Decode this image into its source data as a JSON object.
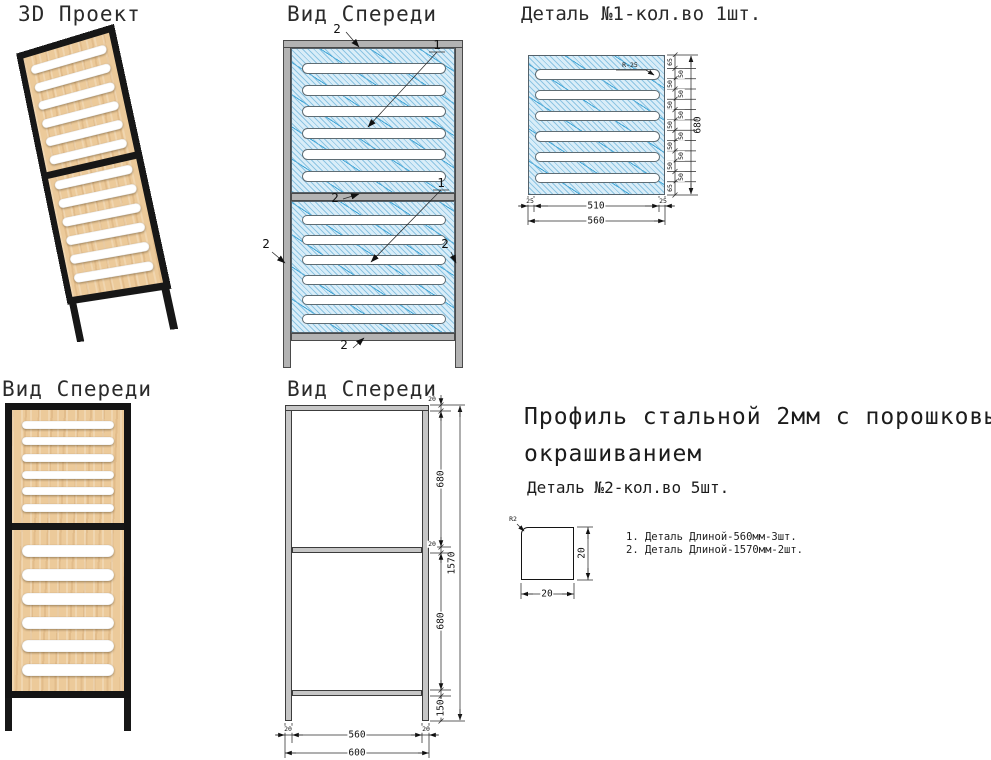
{
  "titles": {
    "view_3d": "3D Проект",
    "front_view_top": "Вид Спереди",
    "detail_1": "Деталь №1-кол.во 1шт.",
    "front_view_bottom_left": "Вид Спереди",
    "front_view_bottom_mid": "Вид Спереди"
  },
  "callouts": {
    "panel_num": "1",
    "profile_num": "2"
  },
  "detail1": {
    "radius_label": "R-25",
    "chain": [
      "65",
      "50",
      "50",
      "50",
      "50",
      "50",
      "50",
      "50",
      "50",
      "50",
      "50",
      "50",
      "65"
    ],
    "height_total": "680",
    "width_left": "25",
    "width_inner": "510",
    "width_right": "25",
    "width_total": "560"
  },
  "frame_dims": {
    "rail_top": "20",
    "upper_opening": "680",
    "rail_mid": "20",
    "lower_opening": "680",
    "leg": "150",
    "height_total": "1570",
    "post_left": "20",
    "width_inner": "560",
    "post_right": "20",
    "width_total": "600"
  },
  "spec": {
    "material_line1": "Профиль стальной 2мм с порошковым",
    "material_line2": "окрашиванием",
    "detail_2": "Деталь №2-кол.во 5шт.",
    "profile": {
      "radius_label": "R2",
      "height": "20",
      "width": "20"
    },
    "notes": [
      "1. Деталь Длиной-560мм-3шт.",
      "2. Деталь Длиной-1570мм-2шт."
    ]
  },
  "colors": {
    "hatch_fill": "#d9edf8",
    "hatch_line": "#5aa9d6",
    "frame_gray": "#b3b3b3",
    "frame_outline": "#4a4a4a",
    "wood": "#ecca9a",
    "steel_black": "#171717",
    "dim_color": "#1a1a1a"
  }
}
